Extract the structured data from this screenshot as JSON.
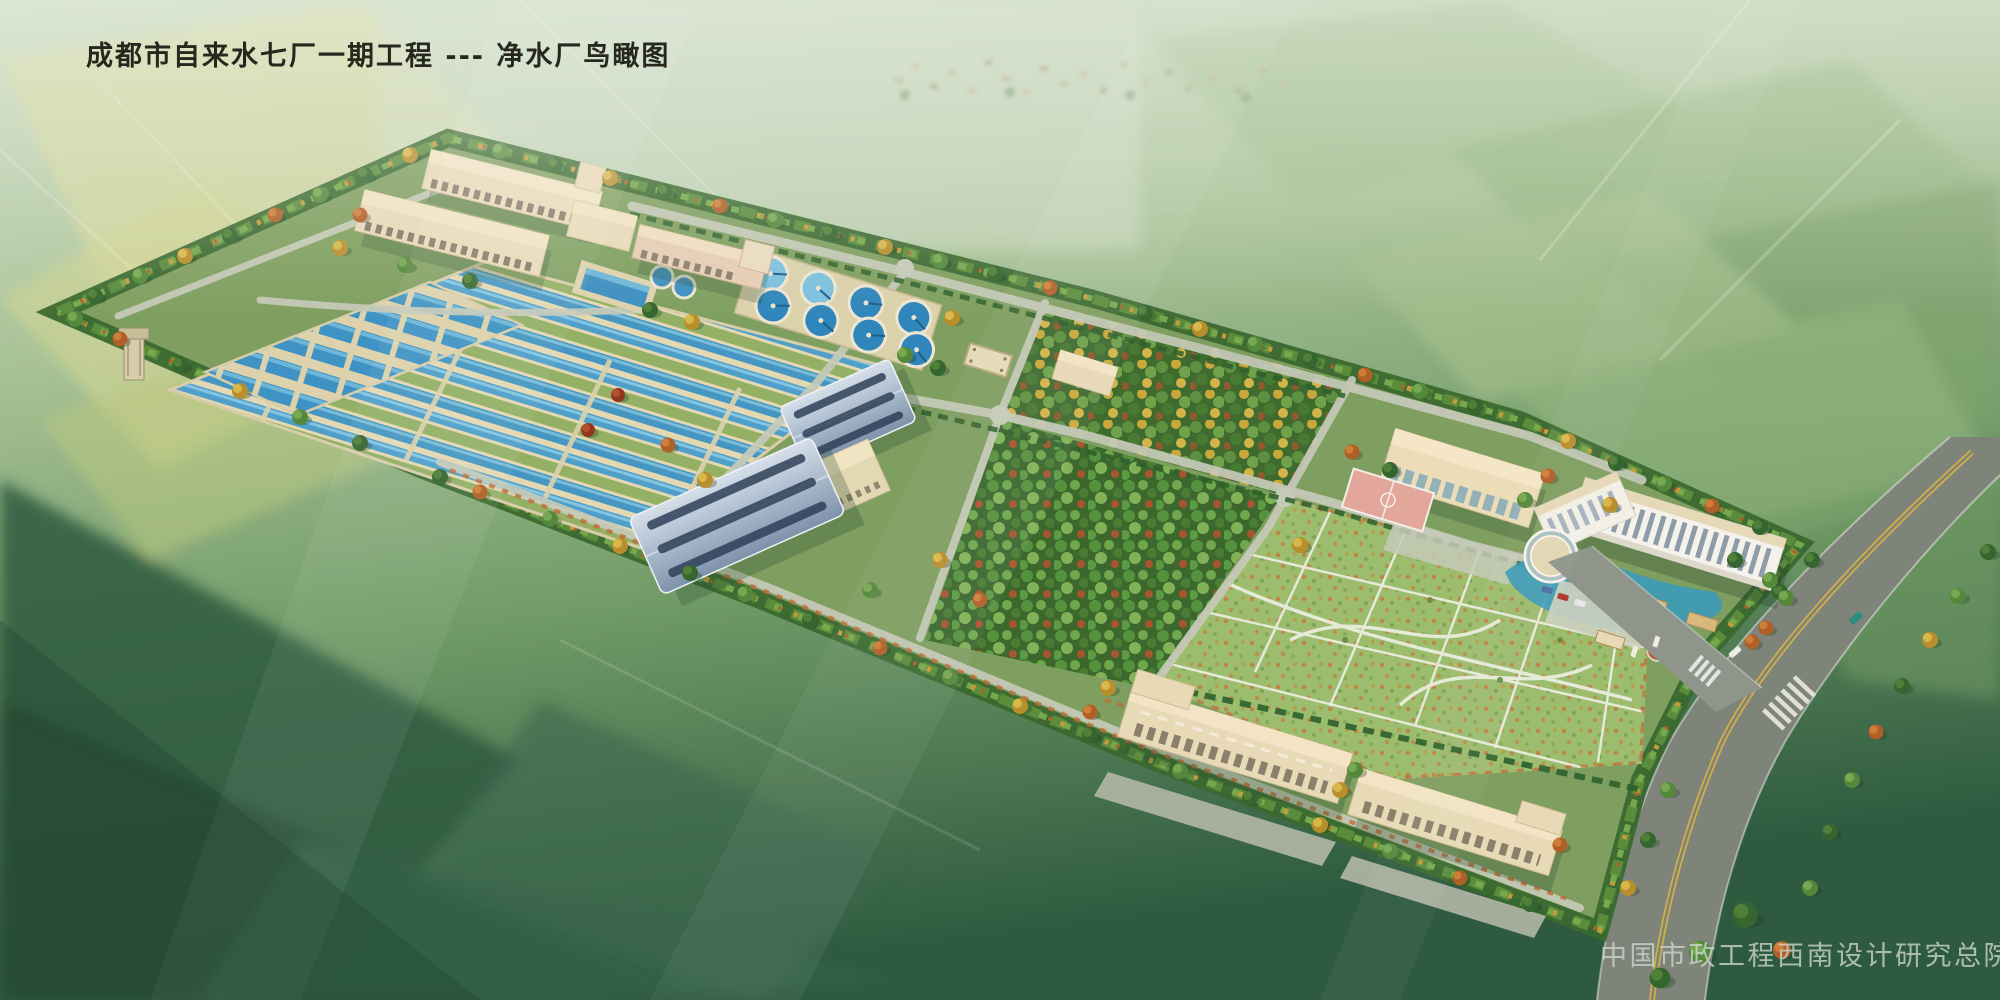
{
  "title": "成都市自来水七厂一期工程 --- 净水厂鸟瞰图",
  "watermark": "中国市政工程西南设计研究总院",
  "scene": {
    "type": "architectural aerial rendering",
    "subject": "water purification plant bird's-eye view over farmland",
    "palette": {
      "farmland_yellow": "#d6d8a0",
      "farmland_green": "#8fae77",
      "site_ground": "#7f9f60",
      "basin_water": "#4f9fca",
      "clarifier_water": "#2f86bb",
      "roof_tan": "#e9dab7",
      "roof_blue_metal": "#9fb2c8",
      "inner_road": "#c6cab8",
      "highway": "#7e847a",
      "lane_marking_yellow": "#d2ae48",
      "tree_dark_green": "#35662f",
      "tree_autumn_yellow": "#c8a93c",
      "tree_autumn_orange": "#bf6b2e",
      "title_color": "#17170f",
      "watermark_color": "#ccd6cc"
    }
  }
}
